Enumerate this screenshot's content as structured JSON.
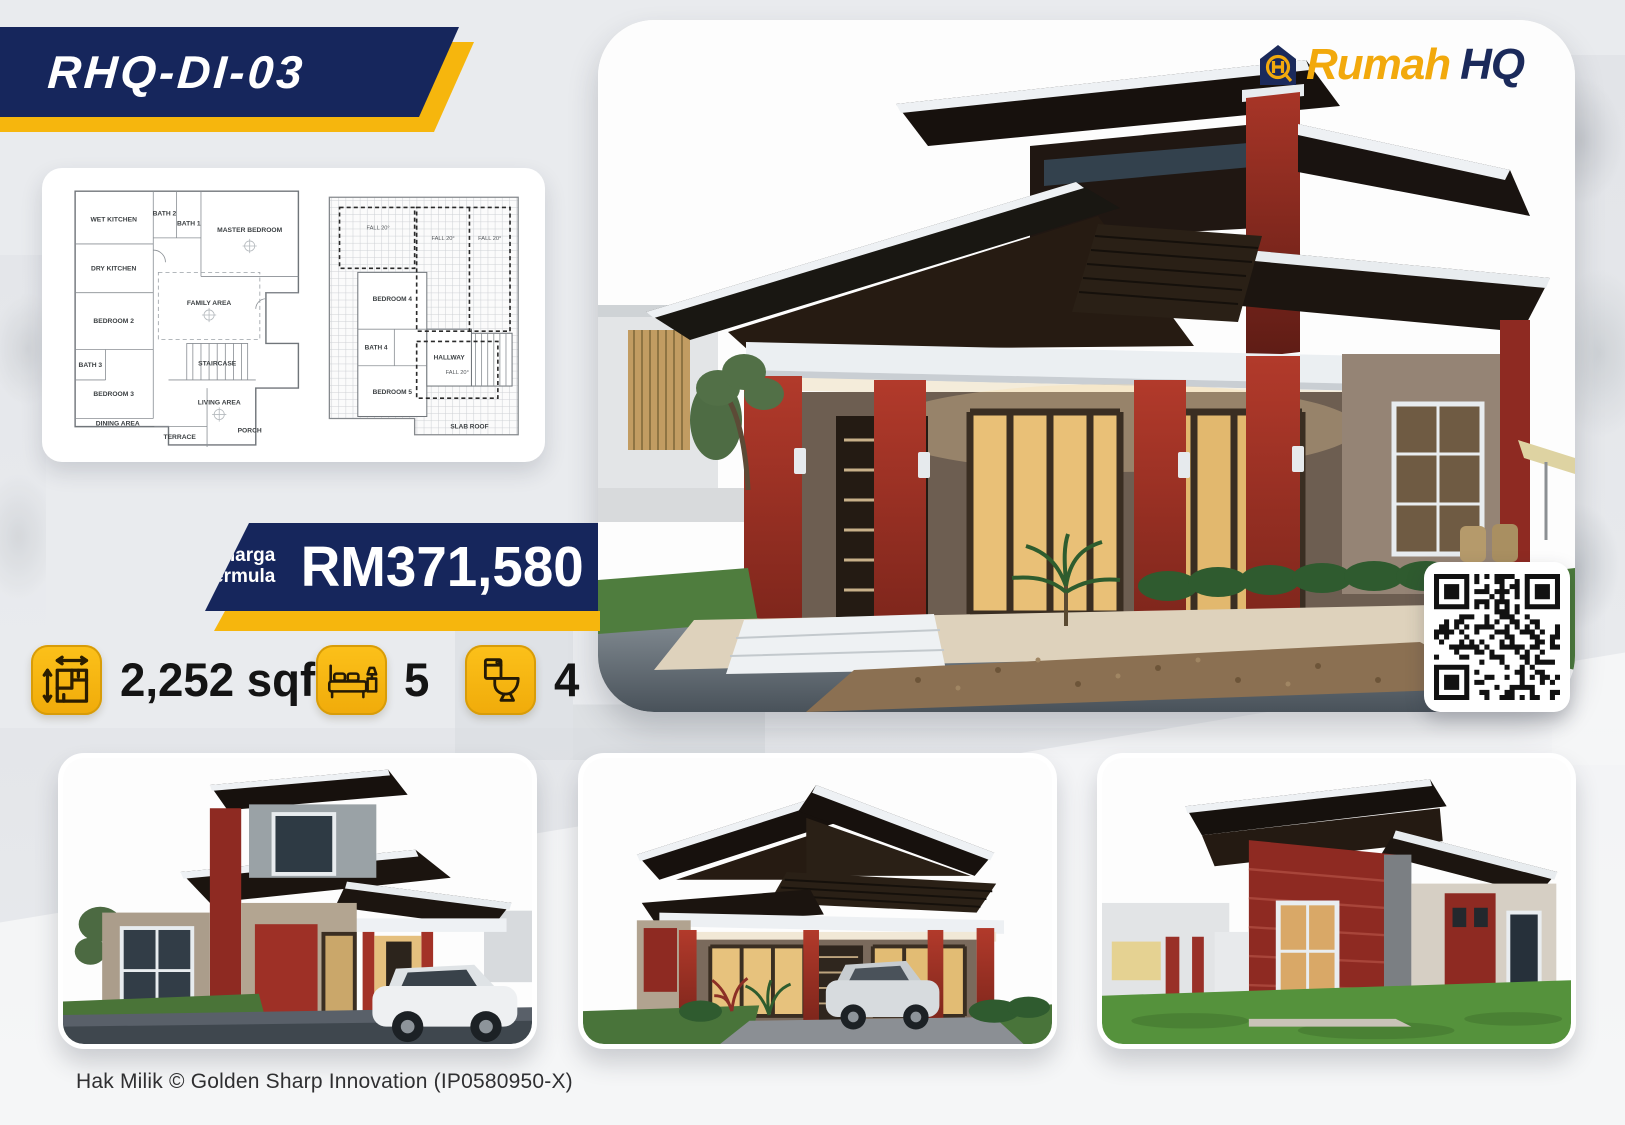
{
  "model_badge": {
    "code": "RHQ-DI-03"
  },
  "brand": {
    "name_accent": "Rumah",
    "name_dark": "HQ"
  },
  "price": {
    "label_top": "Harga",
    "label_bottom": "bermula",
    "amount": "RM371,580"
  },
  "specs": {
    "area": {
      "value": "2,252 sqf"
    },
    "bedrooms": {
      "value": "5"
    },
    "bathrooms": {
      "value": "4"
    }
  },
  "floorplan": {
    "ground": {
      "rooms": [
        "WET KITCHEN",
        "DRY KITCHEN",
        "BATH 2",
        "BATH 1",
        "MASTER BEDROOM",
        "BEDROOM 2",
        "FAMILY AREA",
        "BATH 3",
        "STAIRCASE",
        "BEDROOM 3",
        "LIVING AREA",
        "DINING AREA",
        "TERRACE",
        "PORCH"
      ]
    },
    "first": {
      "rooms": [
        "BEDROOM 4",
        "BATH 4",
        "HALLWAY",
        "BEDROOM 5",
        "SLAB ROOF"
      ],
      "fall_label": "FALL 20°"
    }
  },
  "footer": {
    "copyright": "Hak Milik © Golden Sharp Innovation (IP0580950-X)"
  },
  "colors": {
    "navy": "#16265c",
    "yellow": "#f6b60d",
    "maroon": "#8e2a22",
    "accent_text": "#f2a90c"
  }
}
